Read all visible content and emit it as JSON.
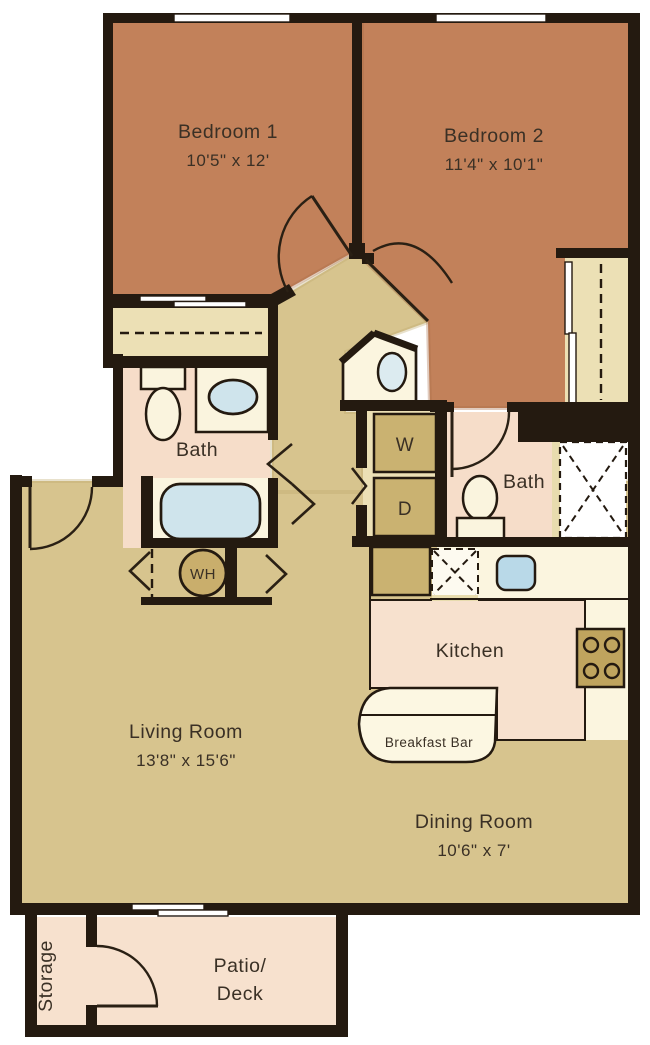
{
  "plan_type": "apartment-floor-plan",
  "rooms": {
    "bedroom1": {
      "name": "Bedroom 1",
      "dims": "10'5\" x 12'"
    },
    "bedroom2": {
      "name": "Bedroom 2",
      "dims": "11'4\" x 10'1\""
    },
    "bath1": {
      "name": "Bath"
    },
    "bath2": {
      "name": "Bath"
    },
    "living": {
      "name": "Living Room",
      "dims": "13'8\" x 15'6\""
    },
    "dining": {
      "name": "Dining Room",
      "dims": "10'6\" x 7'"
    },
    "kitchen": {
      "name": "Kitchen"
    },
    "breakfast_bar": {
      "name": "Breakfast Bar"
    },
    "patio": {
      "line1": "Patio/",
      "line2": "Deck"
    },
    "storage": {
      "name": "Storage"
    }
  },
  "appliances": {
    "washer": "W",
    "dryer": "D",
    "water_heater": "WH"
  },
  "colors": {
    "walls": "#241a10",
    "bedroom_floor": "#c2815a",
    "living_floor": "#d7c48e",
    "bath_kitchen_floor": "#f6ddc9",
    "closet_fill": "#ece0b5",
    "appliance_tan": "#cab271",
    "counter_cream": "#fbf5df",
    "water_blue": "#cfe4ec",
    "background": "#ffffff"
  }
}
